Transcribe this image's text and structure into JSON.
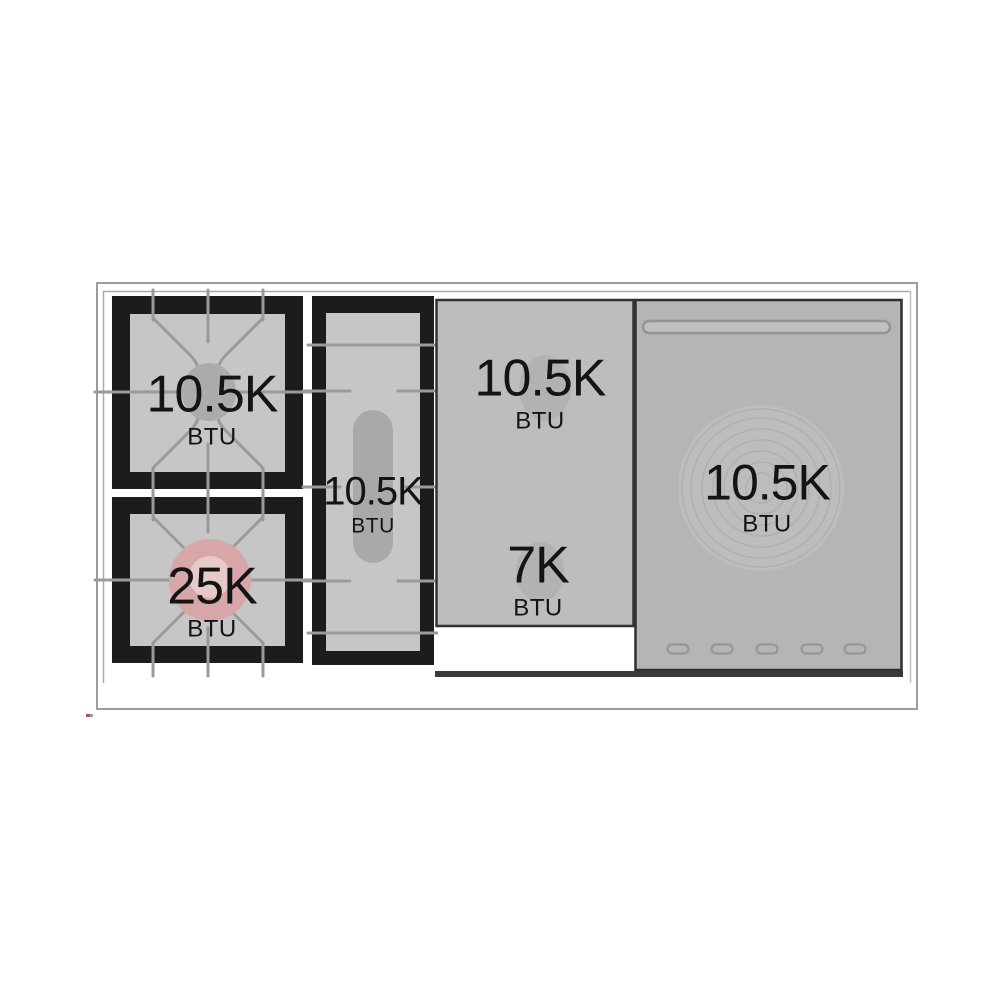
{
  "diagram": {
    "title": "rangetop-burner-btu-layout",
    "colors": {
      "grate_black": "#1c1c1c",
      "grate_surface_gray": "#c6c6c6",
      "panel_gray": "#b5b5b5",
      "griddle_gray": "#bdbdbd",
      "line_gray": "#9a9a9a",
      "burner_gray": "#ababab",
      "highlight_pink": "#d7a6a8",
      "highlight_pink_inner": "#e6c9c9",
      "text": "#141414"
    },
    "burners": [
      {
        "id": "rear-left",
        "btu": "10.5K",
        "unit": "BTU"
      },
      {
        "id": "front-left",
        "btu": "25K",
        "unit": "BTU",
        "highlighted": true
      },
      {
        "id": "center-oval",
        "btu": "10.5K",
        "unit": "BTU"
      },
      {
        "id": "rear-right-zone",
        "btu": "10.5K",
        "unit": "BTU"
      },
      {
        "id": "front-right-zone",
        "btu": "7K",
        "unit": "BTU"
      },
      {
        "id": "french-top",
        "btu": "10.5K",
        "unit": "BTU"
      }
    ]
  }
}
